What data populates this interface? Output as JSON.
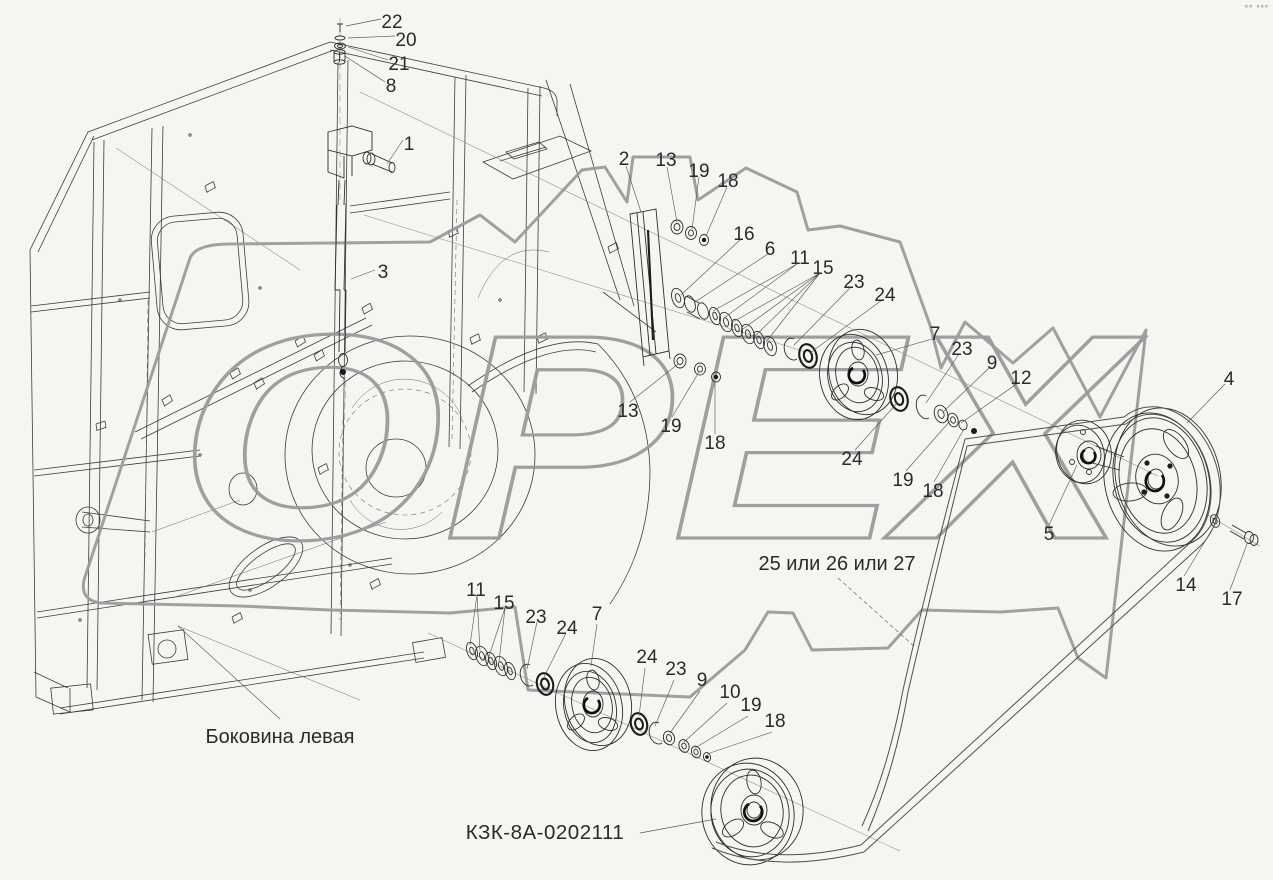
{
  "colors": {
    "background": "#f5f5f2",
    "ink": "#3c3c3c",
    "watermark": "#9b9b9b",
    "label": "#2a2a2a"
  },
  "watermark": "ОРЕХ",
  "corner_marks": "°° °°°",
  "texts": {
    "sidewall_caption": "Боковина левая",
    "belt_note": "25 или 26 или 27",
    "assembly_number": "КЗК-8А-0202111"
  },
  "callouts": [
    "22",
    "20",
    "21",
    "8",
    "1",
    "3",
    "2",
    "13",
    "19",
    "18",
    "16",
    "6",
    "11",
    "15",
    "23",
    "24",
    "13",
    "19",
    "18",
    "7",
    "23",
    "9",
    "12",
    "24",
    "19",
    "18",
    "4",
    "5",
    "14",
    "17",
    "11",
    "15",
    "23",
    "24",
    "7",
    "24",
    "23",
    "9",
    "10",
    "19",
    "18"
  ]
}
